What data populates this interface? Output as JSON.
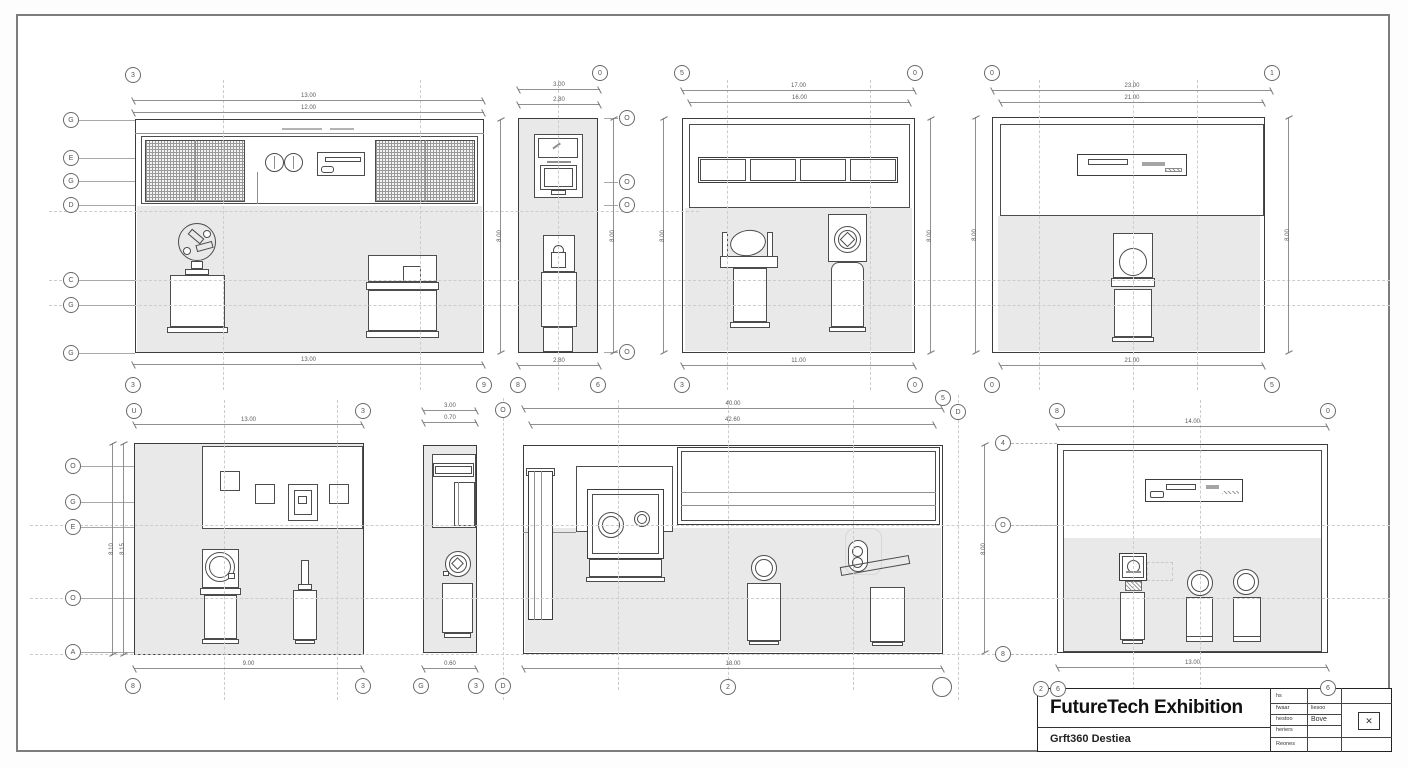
{
  "title_block": {
    "title": "FutureTech Exhibition",
    "subtitle": "Grft360 Destiea",
    "stamp_icon": "✕",
    "rows": [
      {
        "a": "hs",
        "b": ""
      },
      {
        "a": "fwaar",
        "b": "liesoo"
      },
      {
        "a": "hestoo",
        "b": "Bove"
      },
      {
        "a": "heriers",
        "b": ""
      },
      {
        "a": "Reones",
        "b": ""
      }
    ]
  },
  "grid": {
    "left_top": [
      "G",
      "E",
      "G",
      "D",
      "C",
      "G",
      "G"
    ],
    "left_bottom": [
      "O",
      "G",
      "E",
      "O",
      "A"
    ],
    "p8_left": [
      "4",
      "O",
      "8"
    ],
    "p2_side": [
      "O",
      "O",
      "O",
      "O"
    ],
    "p6_top": "O",
    "p6_bottom": "D"
  },
  "panels": {
    "p1": {
      "top1": "13.00",
      "top2": "12.00",
      "bottom": "13.00",
      "right": "8.00",
      "b_top": "3",
      "b_bl": "3",
      "b_br": "9"
    },
    "p2": {
      "top1": "3.00",
      "top2": "2.80",
      "bottom": "2.80",
      "right": "8.00",
      "b_top": "0",
      "b_bl": "8",
      "b_br": "6"
    },
    "p3": {
      "top1": "17.00",
      "top2": "16.00",
      "bottom": "11.00",
      "left": "8.00",
      "right": "8.00",
      "b_tl": "5",
      "b_tr": "0",
      "b_bl": "3",
      "b_br": "0"
    },
    "p4": {
      "top1": "23.00",
      "top2": "21.00",
      "bottom": "21.00",
      "left": "8.00",
      "right": "8.00",
      "b_tl": "0",
      "b_tr": "1",
      "b_bl": "0",
      "b_br": "5"
    },
    "p5": {
      "top": "13.00",
      "bottom": "9.00",
      "left1": "8.10",
      "left2": "8.15",
      "b_tl": "U",
      "b_tr": "3",
      "b_bl": "8",
      "b_br": "3"
    },
    "p6": {
      "top1": "3.00",
      "top2": "0.70",
      "bottom": "0.60",
      "b_bl": "G",
      "b_br": "3"
    },
    "p7": {
      "top1": "40.00",
      "top2": "42.60",
      "bottom": "18.00",
      "b_tr1": "5",
      "b_tr2": "D",
      "b_bc": "2"
    },
    "p8": {
      "top": "14.00",
      "bottom": "13.00",
      "left": "8.00",
      "b_tl": "8",
      "b_tr": "0",
      "b_b1": "2",
      "b_b2": "6",
      "b_b3": "6"
    }
  }
}
